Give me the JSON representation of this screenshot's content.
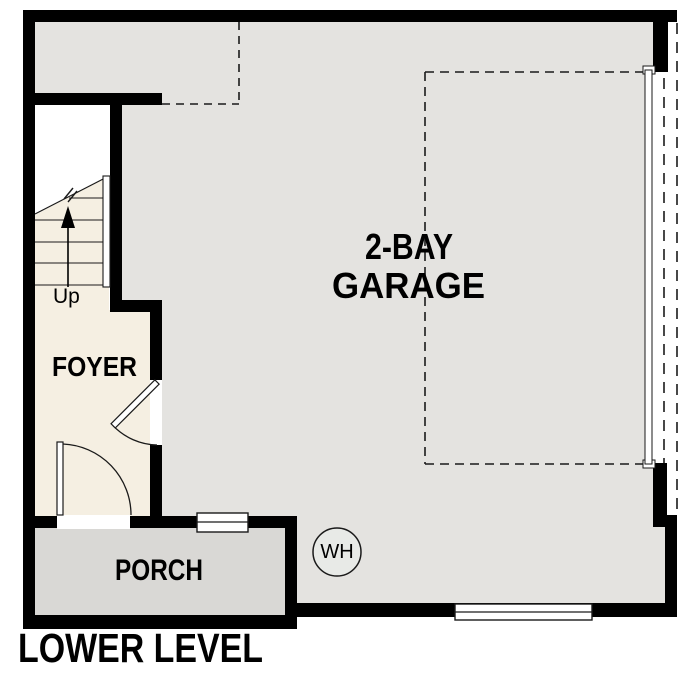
{
  "plan": {
    "title": "LOWER LEVEL",
    "rooms": {
      "garage": {
        "label_line1": "2-BAY",
        "label_line2": "GARAGE"
      },
      "foyer": {
        "label": "FOYER"
      },
      "porch": {
        "label": "PORCH"
      }
    },
    "stairs": {
      "direction_label": "Up",
      "icon": "up-arrow-icon"
    },
    "fixtures": {
      "water_heater_label": "WH"
    }
  },
  "colors": {
    "wall": "#000000",
    "garage_floor": "#e4e3e0",
    "foyer_floor": "#f5efe2",
    "porch_floor": "#d9d8d5",
    "stairwell": "#ffffff",
    "water_heater_fill": "#e8eae7",
    "line": "#1a1a1a"
  }
}
